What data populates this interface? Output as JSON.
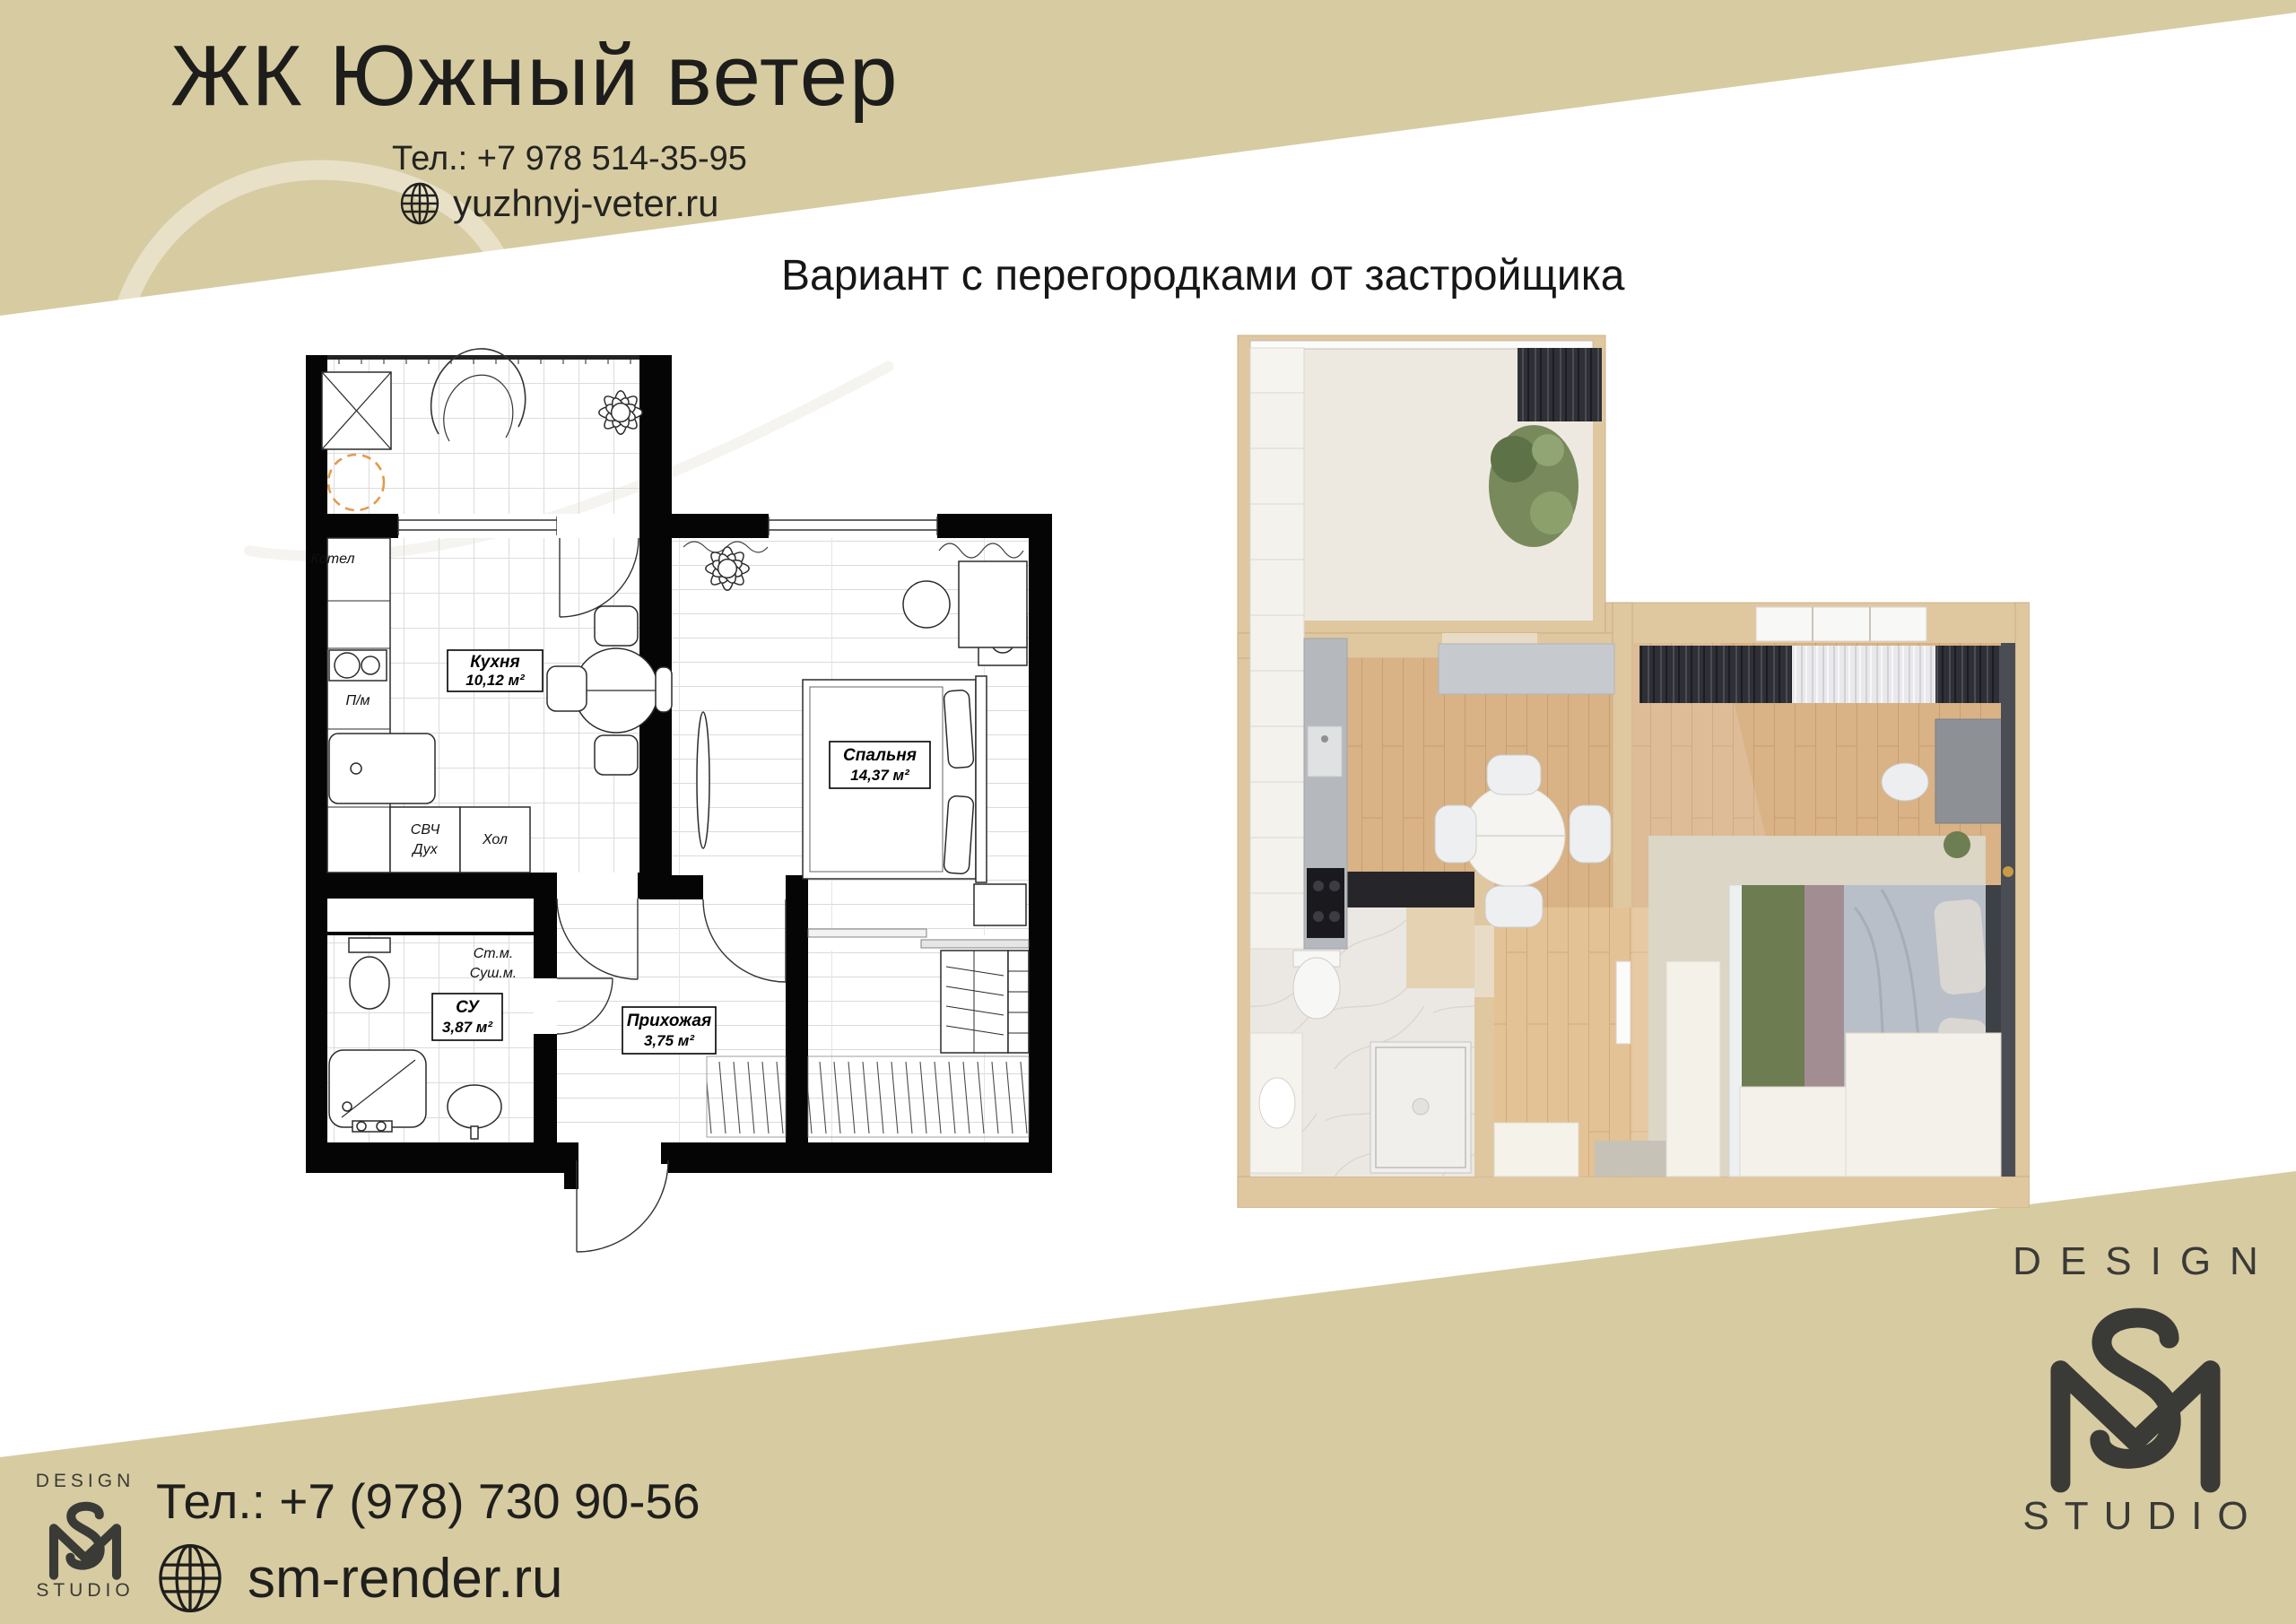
{
  "page": {
    "background": "#ffffff",
    "band_color": "#d7cba1"
  },
  "header": {
    "title": "ЖК Южный ветер",
    "phone": "Тел.: +7 978 514-35-95",
    "website": "yuzhnyj-veter.ru"
  },
  "subtitle": "Вариант с перегородками от застройщика",
  "plan2d": {
    "rooms": {
      "kitchen": {
        "name": "Кухня",
        "area": "10,12 м²"
      },
      "bedroom": {
        "name": "Спальня",
        "area": "14,37 м²"
      },
      "bathroom": {
        "name": "СУ",
        "area": "3,87 м²"
      },
      "hallway": {
        "name": "Прихожая",
        "area": "3,75 м²"
      }
    },
    "equipment": {
      "boiler": "Котел",
      "dishwasher": "П/м",
      "microwave": "СВЧ",
      "oven": "Дух",
      "fridge": "Хол",
      "washing_machine": "Ст.м.",
      "dryer": "Суш.м."
    }
  },
  "footer": {
    "phone": "Тел.: +7 (978) 730 90-56",
    "website": "sm-render.ru"
  },
  "logo": {
    "design": "DESIGN",
    "studio": "STUDIO"
  },
  "colors": {
    "band": "#d7cba1",
    "logo": "#3a3a37",
    "plan_outline": "#000000",
    "boiler_dash": "#e39a4e",
    "render_wall": "#dfc7a0",
    "render_wood": "#d9b286"
  }
}
